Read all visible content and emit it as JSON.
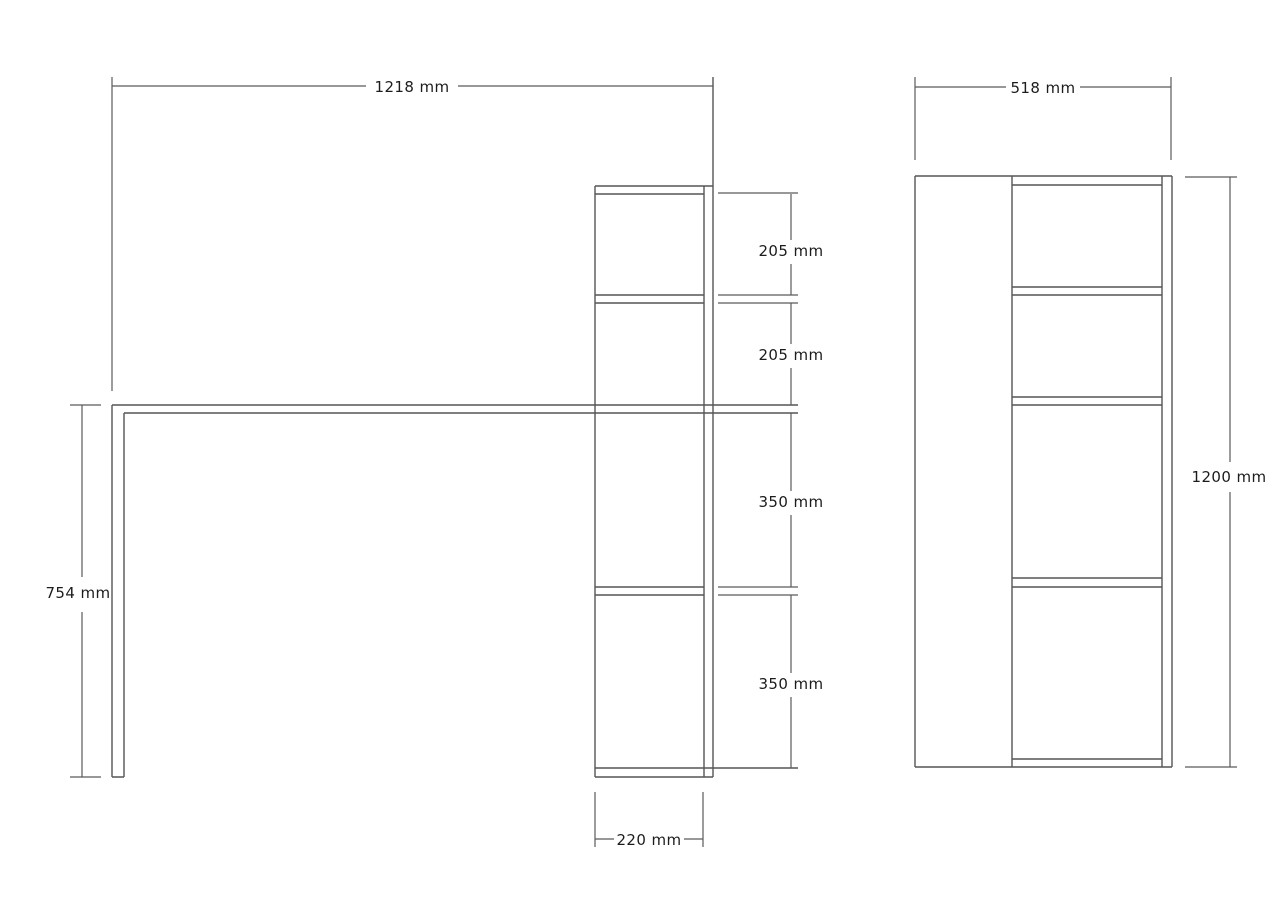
{
  "colors": {
    "background": "#ffffff",
    "line": "#555555",
    "text": "#1c1c1c"
  },
  "front_view": {
    "overall_width_label": "1218 mm",
    "desk_height_label": "754 mm",
    "section_labels": [
      "205 mm",
      "205 mm",
      "350 mm",
      "350 mm"
    ],
    "shelf_depth_label": "220 mm"
  },
  "side_view": {
    "overall_depth_label": "518 mm",
    "overall_height_label": "1200 mm"
  }
}
